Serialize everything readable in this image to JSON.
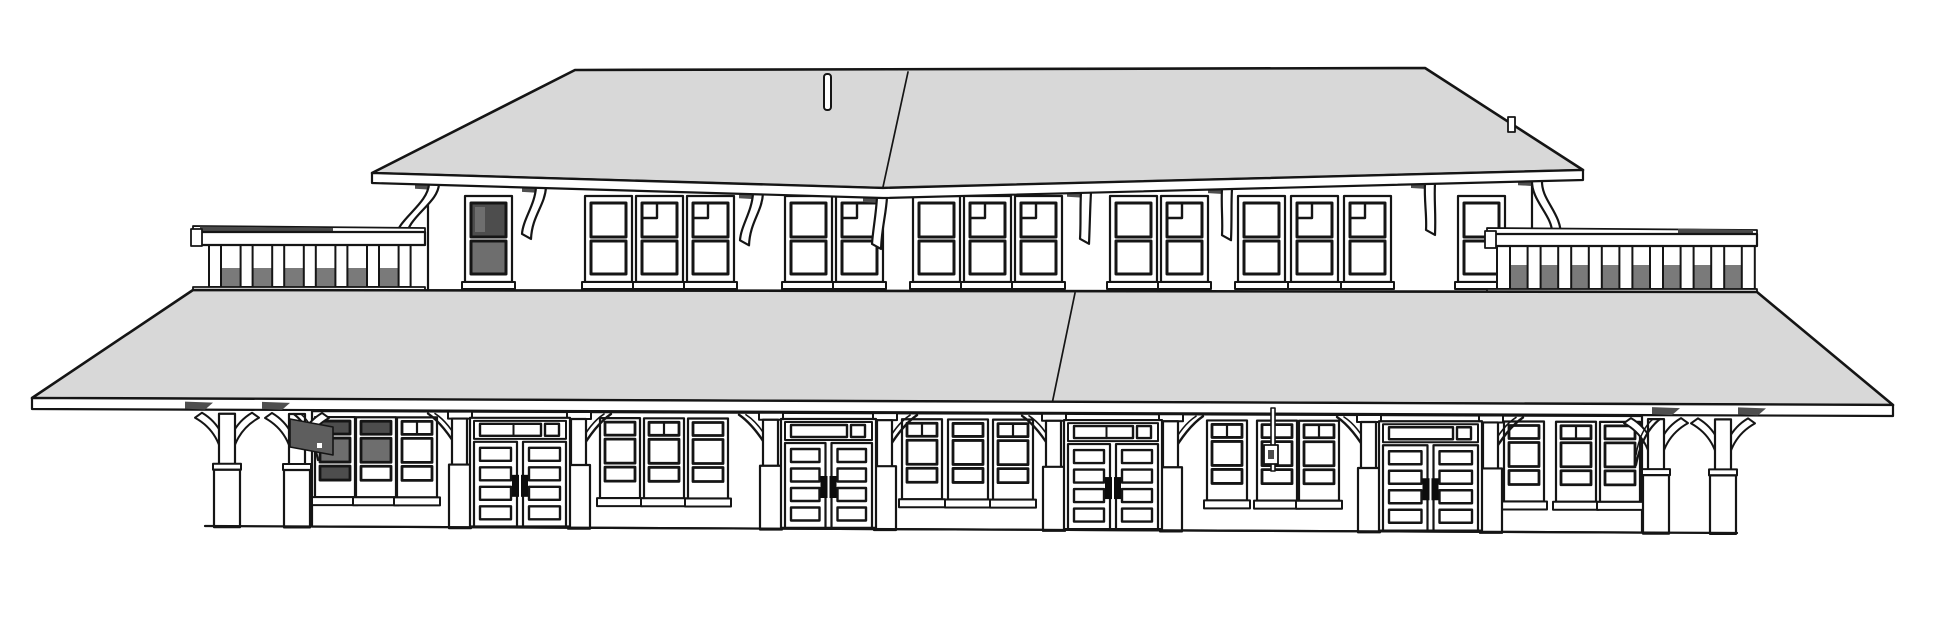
{
  "meta": {
    "description": "Monochrome 3D line rendering (elevation view) of a railroad depot: clerestory upper level with hipped gray roof and bracketed eaves, two roof-deck balustrades, a full-width gray platform canopy, and a lower facade with paneled double doors, triple window bays, station sign board and canopy support columns.",
    "visible_text": "",
    "counts": {
      "upper_windows": 15,
      "lower_windows": 15,
      "double_doors": 4,
      "balustrades": 2,
      "free_columns": 4,
      "eave_brackets": 8
    }
  },
  "colors": {
    "background": "#ffffff",
    "outline": "#151515",
    "roof_gray": "#d8d8d8",
    "dark_glass": "#4d4d4d",
    "glass_light": "#6e6e6e",
    "gap_gray": "#7a7a7a",
    "rail_dark": "#4a4a4a",
    "sign_gray": "#5e5e5e",
    "soffit": "#4f4f4f",
    "white": "#ffffff"
  },
  "scene": {
    "upper_roof": {
      "eave": [
        [
          372,
          173
        ],
        [
          883,
          188
        ],
        [
          1583,
          170
        ]
      ],
      "ridge": [
        [
          575,
          70
        ],
        [
          1425,
          68
        ]
      ],
      "seam": [
        [
          908,
          72
        ],
        [
          883,
          187
        ]
      ],
      "fascia_h": 10,
      "finial": {
        "x": 824,
        "y": 74,
        "w": 7,
        "h": 36
      },
      "vent": {
        "x": 1508,
        "y": 117,
        "w": 7,
        "h": 15
      }
    },
    "upper_story": {
      "left": 428,
      "right": 1532,
      "bottom": 296
    },
    "upper_windows": {
      "w": 47,
      "h": 86,
      "y": 196,
      "items": [
        {
          "x": 465,
          "dark": true
        },
        {
          "x": 585
        },
        {
          "x": 636,
          "muntin": true
        },
        {
          "x": 687,
          "muntin": true
        },
        {
          "x": 785
        },
        {
          "x": 836,
          "muntin": true
        },
        {
          "x": 913
        },
        {
          "x": 964,
          "muntin": true
        },
        {
          "x": 1015,
          "muntin": true
        },
        {
          "x": 1110
        },
        {
          "x": 1161,
          "muntin": true
        },
        {
          "x": 1238
        },
        {
          "x": 1291,
          "muntin": true
        },
        {
          "x": 1344,
          "muntin": true
        },
        {
          "x": 1458
        }
      ]
    },
    "eave_brackets": [
      {
        "x": 433,
        "lean": -26,
        "h": 58
      },
      {
        "x": 540,
        "lean": -7,
        "h": 52
      },
      {
        "x": 757,
        "lean": -6,
        "h": 52
      },
      {
        "x": 881,
        "lean": 2,
        "h": 52
      },
      {
        "x": 1085,
        "lean": 6,
        "h": 52
      },
      {
        "x": 1226,
        "lean": 7,
        "h": 52
      },
      {
        "x": 1429,
        "lean": 8,
        "h": 52
      },
      {
        "x": 1536,
        "lean": 27,
        "h": 58
      }
    ],
    "balustrades": {
      "left": {
        "x1": 193,
        "x2": 425,
        "top": 226,
        "rail_bottom": 245,
        "base": 287,
        "dark_top": [
          200,
          333
        ],
        "balusters": {
          "start": 209,
          "count": 7,
          "spacing": 31.6,
          "width": 12
        },
        "gap_shadow_top": 268
      },
      "right": {
        "x1": 1487,
        "x2": 1757,
        "top": 228,
        "rail_bottom": 246,
        "base": 289,
        "dark_top": [
          1678,
          1753
        ],
        "balusters": {
          "start": 1497,
          "count": 9,
          "spacing": 30.6,
          "width": 13
        },
        "gap_shadow_top": 265
      }
    },
    "canopy": {
      "surface": [
        [
          193,
          290
        ],
        [
          1757,
          292
        ],
        [
          1893,
          405
        ],
        [
          32,
          398
        ]
      ],
      "fascia": [
        [
          32,
          398
        ],
        [
          1893,
          405
        ],
        [
          1893,
          416
        ],
        [
          32,
          409
        ]
      ],
      "seam": [
        [
          1075,
          293
        ],
        [
          1052,
          404
        ]
      ],
      "fascia_bottom": [
        [
          32,
          409
        ],
        [
          1893,
          416
        ]
      ]
    },
    "lower_story": {
      "wall_left": 312,
      "wall_right": 1642,
      "ground": [
        [
          205,
          526
        ],
        [
          1737,
          533
        ]
      ]
    },
    "lower_windows": {
      "w": 40,
      "h": 80,
      "items": [
        {
          "x": 315,
          "dark": "full"
        },
        {
          "x": 356,
          "dark": "upper"
        },
        {
          "x": 397,
          "split": true
        },
        {
          "x": 600
        },
        {
          "x": 644,
          "split": true
        },
        {
          "x": 688
        },
        {
          "x": 902,
          "split": true
        },
        {
          "x": 948
        },
        {
          "x": 993,
          "split": true
        },
        {
          "x": 1207,
          "split": true
        },
        {
          "x": 1257
        },
        {
          "x": 1299,
          "split": true
        },
        {
          "x": 1504
        },
        {
          "x": 1556,
          "split": true
        },
        {
          "x": 1600
        }
      ]
    },
    "doors": {
      "items": [
        {
          "x": 474,
          "w": 92,
          "transom_divisions": 3
        },
        {
          "x": 785,
          "w": 87,
          "transom_divisions": 2
        },
        {
          "x": 1068,
          "w": 90,
          "transom_divisions": 3
        },
        {
          "x": 1383,
          "w": 95,
          "transom_divisions": 2
        }
      ]
    },
    "columns": {
      "items": [
        {
          "x": 227
        },
        {
          "x": 297
        },
        {
          "x": 1656
        },
        {
          "x": 1723
        }
      ]
    },
    "corner_braces": [
      {
        "x": 318,
        "dir": -1
      },
      {
        "x": 1636,
        "dir": 1
      }
    ],
    "soffit_shadows": [
      {
        "x": 185
      },
      {
        "x": 262
      },
      {
        "x": 1652
      },
      {
        "x": 1738
      }
    ],
    "sign": {
      "points": [
        [
          290,
          419
        ],
        [
          333,
          427
        ],
        [
          333,
          455
        ],
        [
          290,
          447
        ]
      ],
      "dot": [
        317,
        443,
        5,
        5
      ]
    },
    "standpipe": {
      "x": 1271,
      "top": 408,
      "bottom": 471,
      "box": [
        1264,
        445,
        14,
        19
      ]
    }
  }
}
